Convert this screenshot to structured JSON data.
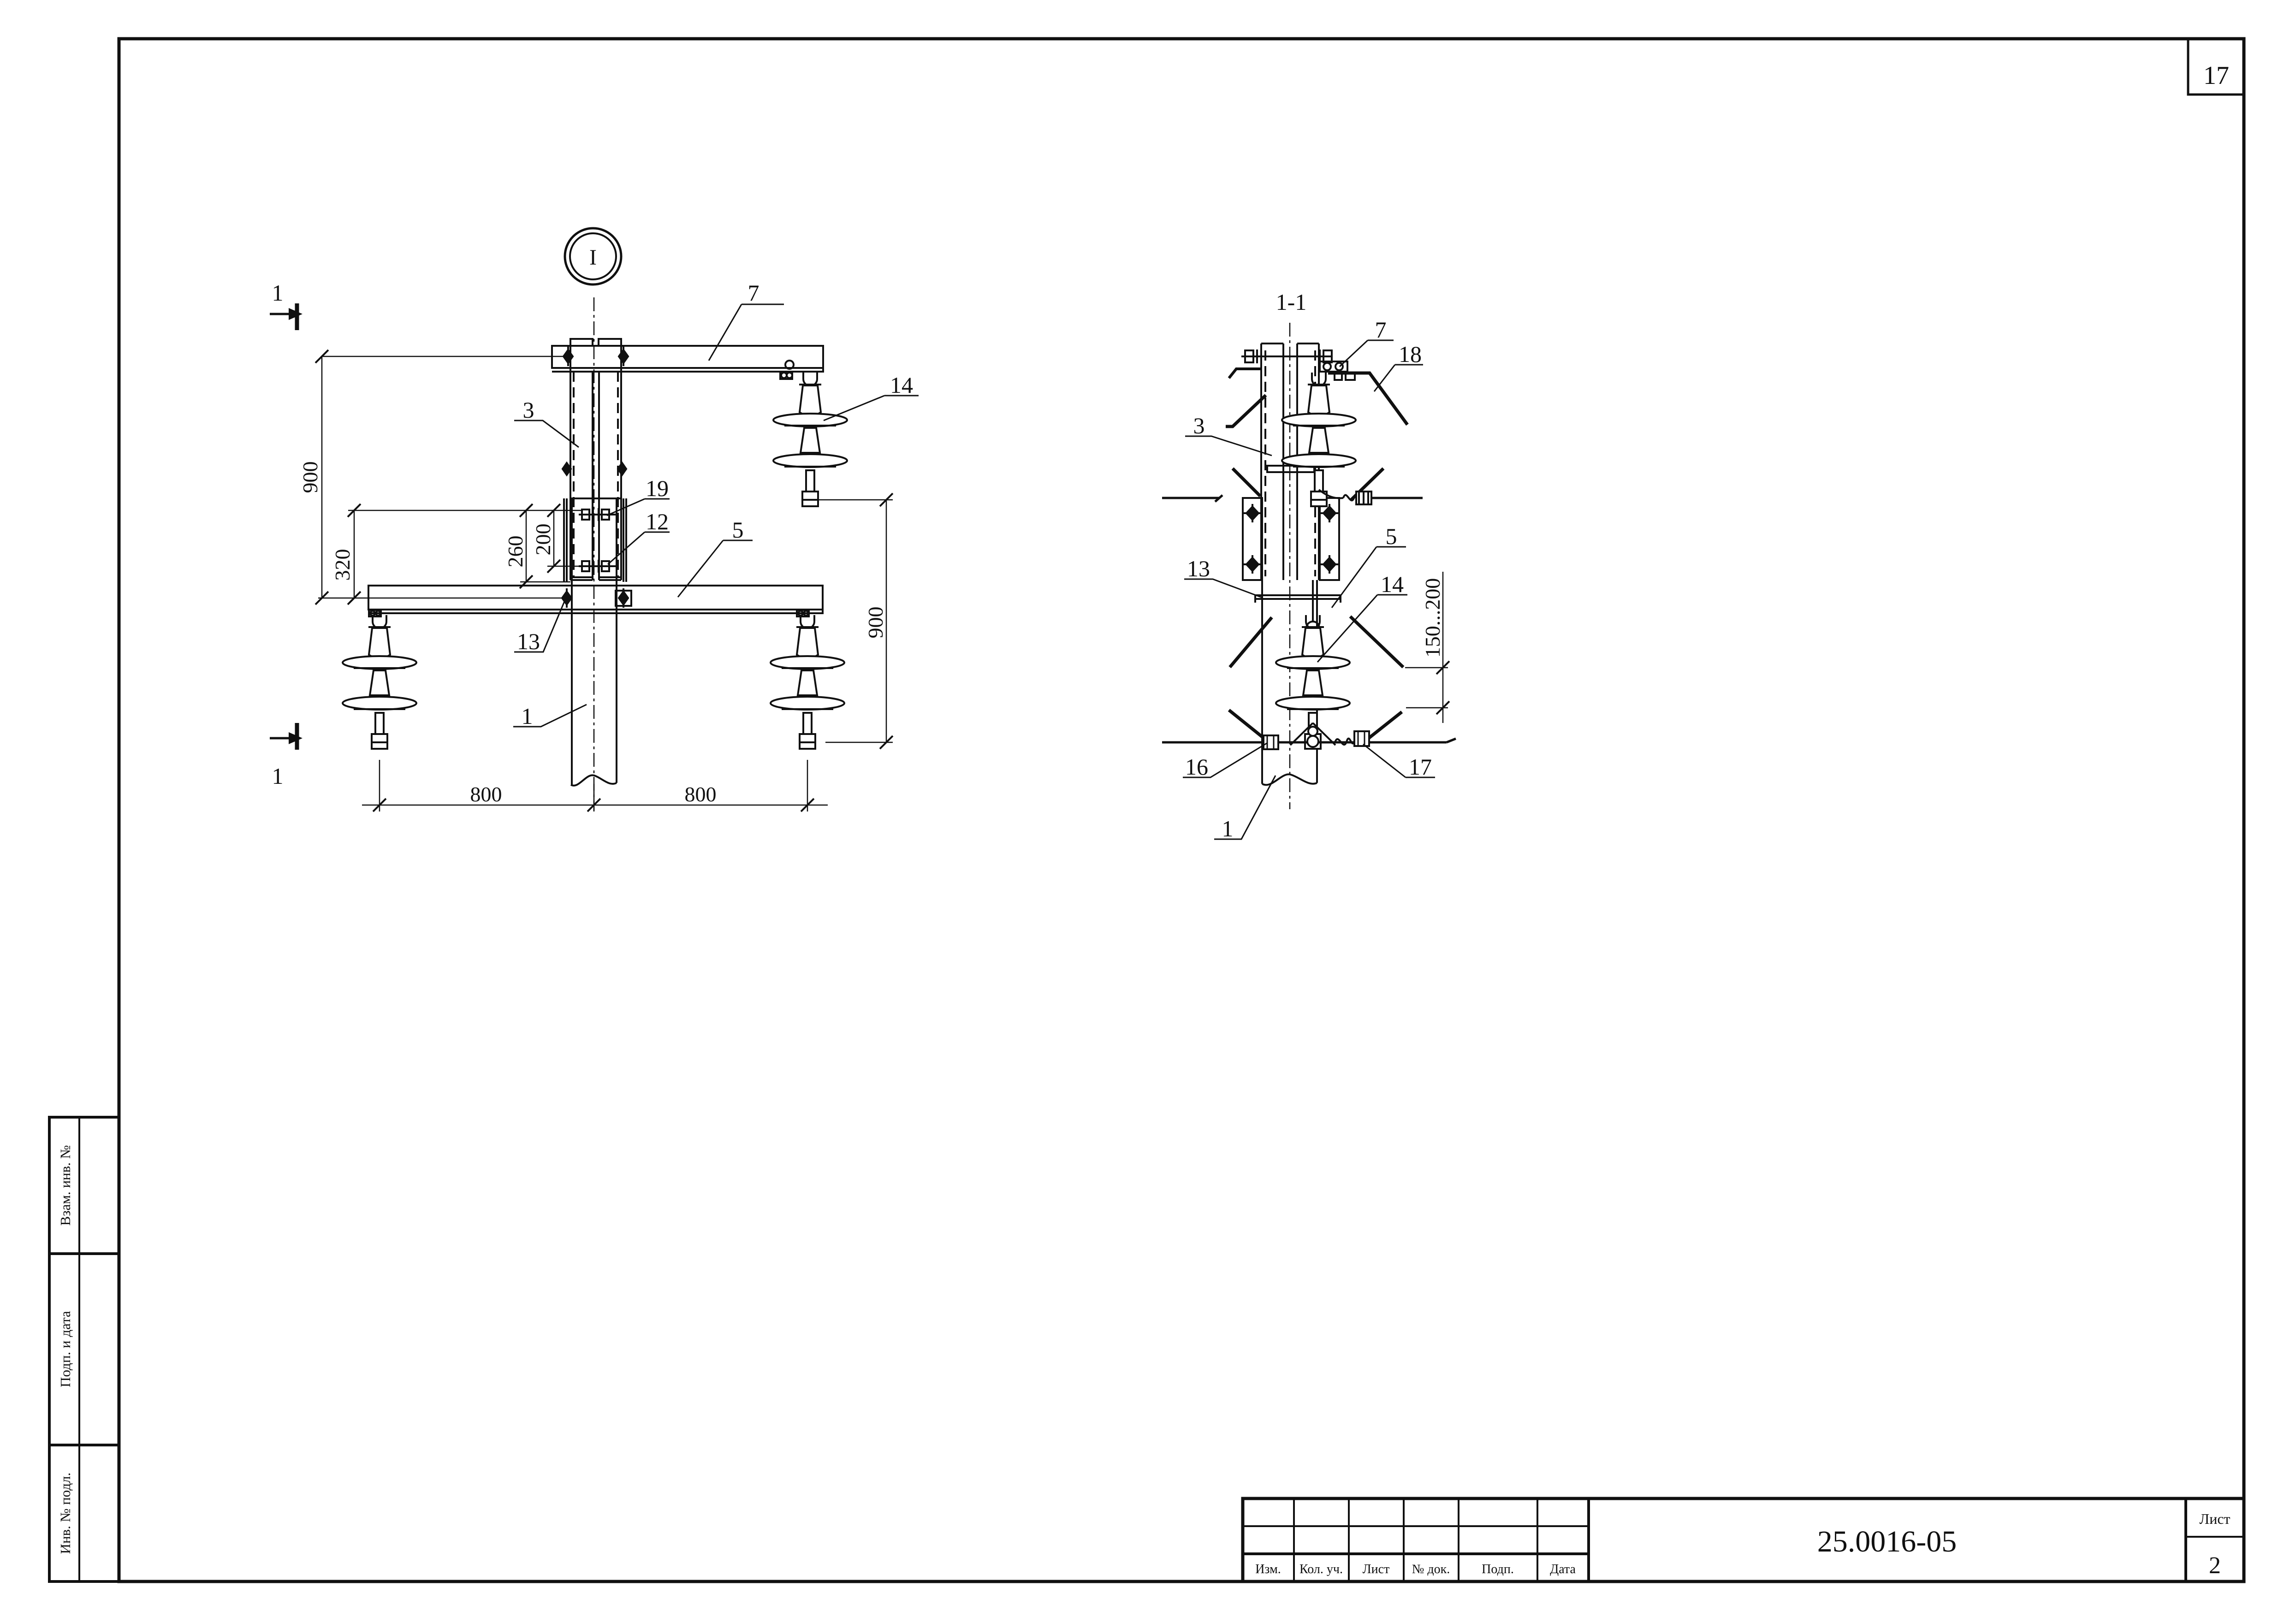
{
  "page": {
    "sheet_corner": "17"
  },
  "side_stamp": {
    "rows": [
      "Взам. инв. №",
      "Подп. и дата",
      "Инв. № подл."
    ]
  },
  "title_block": {
    "doc_number": "25.0016-05",
    "sheet_label": "Лист",
    "sheet_number": "2",
    "columns": [
      "Изм.",
      "Кол. уч.",
      "Лист",
      "№ док.",
      "Подп.",
      "Дата"
    ]
  },
  "front_view": {
    "detail_marker": "I",
    "section_cut_label_top": "1",
    "section_cut_label_bottom": "1",
    "callouts": {
      "pole": "1",
      "stub": "3",
      "lower_crossarm": "5",
      "upper_crossarm": "7",
      "lower_bolt": "12",
      "crossarm_bolt": "13",
      "insulator": "14",
      "upper_bolt": "19"
    },
    "dims": {
      "d900_left": "900",
      "d320": "320",
      "d260": "260",
      "d200": "200",
      "d900_right": "900",
      "d800_left": "800",
      "d800_right": "800"
    }
  },
  "section_view": {
    "title": "1-1",
    "callouts": {
      "pole": "1",
      "stub": "3",
      "lower_crossarm": "5",
      "upper_crossarm": "7",
      "strap": "13",
      "insulator": "14",
      "clamp_left": "16",
      "clamp_right": "17",
      "rod": "18"
    },
    "dims": {
      "d150_200": "150...200"
    }
  }
}
